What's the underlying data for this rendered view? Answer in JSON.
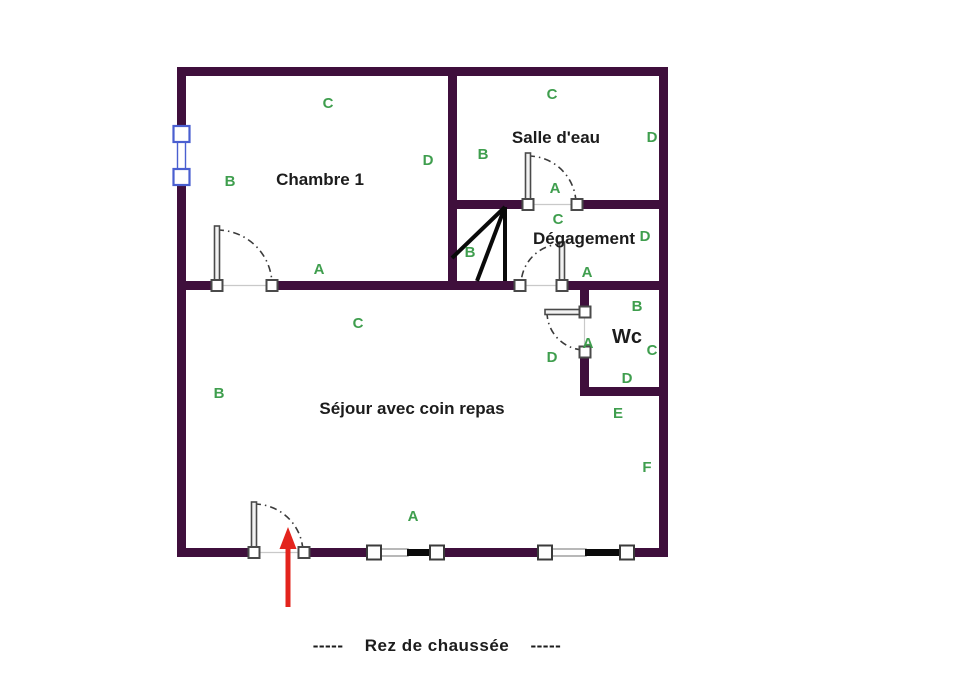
{
  "floor_name": "Rez de chaussée",
  "caption": {
    "dashes_left": "-----",
    "text": "Rez de chaussée",
    "dashes_right": "-----"
  },
  "rooms": {
    "chambre1": "Chambre 1",
    "salle_deau": "Salle d'eau",
    "degagement": "Dégagement",
    "wc": "Wc",
    "sejour": "Séjour avec coin repas"
  },
  "letters": {
    "chambre1_top": "C",
    "chambre1_left": "B",
    "chambre1_right": "D",
    "chambre1_bottom": "A",
    "salle_top": "C",
    "salle_left": "B",
    "salle_right": "D",
    "salle_door": "A",
    "stairs": "B",
    "degagement_top": "C",
    "degagement_right": "D",
    "degagement_door": "A",
    "wc_top": "B",
    "wc_right": "C",
    "wc_bottom": "D",
    "wc_door": "A",
    "wc_outside": "D",
    "sejour_top": "C",
    "sejour_left": "B",
    "sejour_bottom": "A",
    "exterior_e": "E",
    "exterior_f": "F"
  },
  "colors": {
    "wall": "#3f0f3c",
    "label_green": "#3f9e4e",
    "text": "#1c1c1c",
    "arrow_red": "#e3241d",
    "window_frame_blue": "#4a5fd0"
  }
}
